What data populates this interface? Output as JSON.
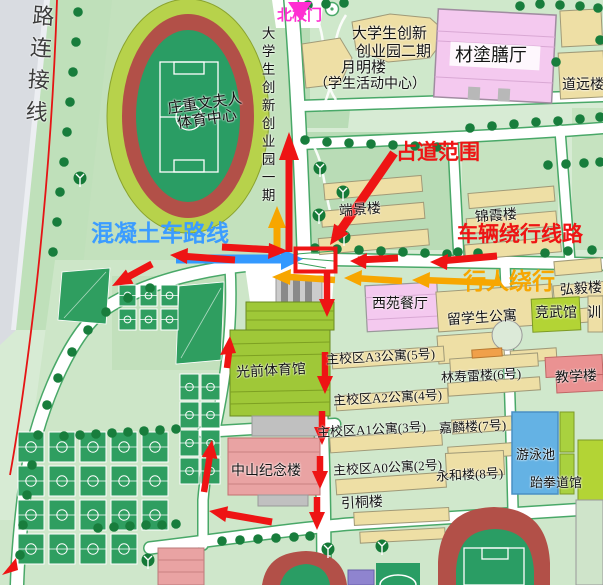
{
  "annotations": {
    "north_gate": "北校门",
    "occupied_area": "占道范围",
    "vehicle_detour": "车辆绕行线路",
    "pedestrian_detour": "行人绕行",
    "concrete_truck_route": "混凝土车路线"
  },
  "roads": {
    "connector": "路连接线"
  },
  "places": {
    "stadium_line1": "庄重文夫人",
    "stadium_line2": "体育中心",
    "innovation_park_phase1": "大学生创新创业园一期",
    "innovation_park_phase2_line1": "大学生创新",
    "innovation_park_phase2_line2": "创业园二期",
    "yueming_building": "月明楼",
    "student_activity_center": "（学生活动中心）",
    "caitu_dining_hall": "材塗膳厅",
    "daoyuan_building": "道远楼",
    "duanjing_building": "端景楼",
    "jinxia_building": "锦霞楼",
    "hongyi_building": "弘毅楼",
    "xiyuan_dining_hall": "西苑餐厅",
    "intl_student_apartment": "留学生公寓",
    "jingwu_hall": "竞武馆",
    "xun_partial": "训",
    "apartment_a3": "主校区A3公寓(5号)",
    "linshoulei_building": "林寿雷楼(6号)",
    "teaching_building": "教学楼",
    "apartment_a2": "主校区A2公寓(4号)",
    "apartment_a1": "主校区A1公寓(3号)",
    "jialin_building": "嘉麟楼(7号)",
    "apartment_a0": "主校区A0公寓(2号)",
    "yonghe_building": "永和楼(8号)",
    "yintong_building": "引桐楼",
    "swimming_pool": "游泳池",
    "taekwondo_hall": "跆拳道馆",
    "guangqian_gym": "光前体育馆",
    "zhongshan_memorial": "中山纪念楼"
  },
  "colors": {
    "arrow_red": "#ee1414",
    "arrow_orange": "#f7a600",
    "arrow_blue": "#3399ff",
    "gate_magenta": "#ff2ed2",
    "track_red": "#b25048",
    "field_green": "#2a9d64",
    "building_tan": "#eedfa5",
    "building_pink": "#f4c9ef",
    "pool_blue": "#64b2e4"
  }
}
